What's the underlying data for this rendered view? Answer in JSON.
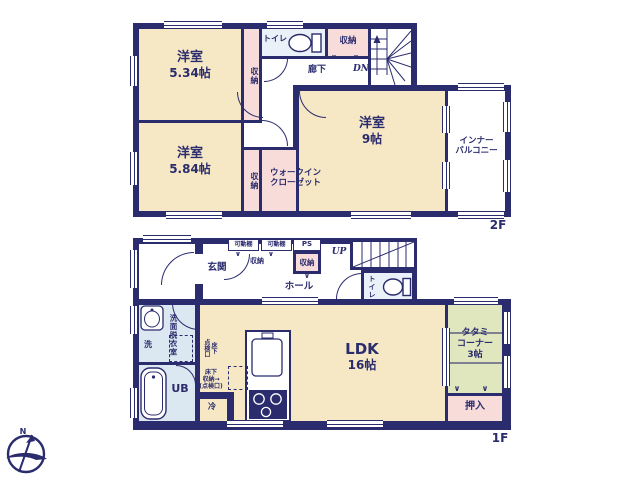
{
  "colors": {
    "wall": "#2b2c6e",
    "room": "#f6e8c4",
    "storage": "#f8dcd9",
    "tatami": "#e0e6bd",
    "wet": "#dce8f1",
    "toilet": "#eaf1f8"
  },
  "floor2": {
    "label": "2F",
    "bedroom_small": {
      "name": "洋室",
      "size": "5.34帖"
    },
    "bedroom_mid": {
      "name": "洋室",
      "size": "5.84帖"
    },
    "bedroom_large": {
      "name": "洋室",
      "size": "9帖"
    },
    "closet_left_top": "収納",
    "closet_left_bottom": "収納",
    "closet_hall": "収納",
    "toilet": "トイレ",
    "hallway": "廊下",
    "stairs_down": "DN",
    "wic": {
      "line1": "ウォークイン",
      "line2": "クローゼット"
    },
    "balcony": {
      "line1": "インナー",
      "line2": "バルコニー"
    }
  },
  "floor1": {
    "label": "1F",
    "entrance": "玄関",
    "hall": "ホール",
    "shelf_left": "可動棚",
    "shelf_right": "可動棚",
    "entrance_closet": "収納",
    "ps": "PS",
    "hall_closet": "収納",
    "stairs_up": "UP",
    "toilet": "トイレ",
    "washroom": "洗面脱衣室",
    "washer": "洗",
    "bath": "UB",
    "fridge": "冷",
    "ldk": {
      "name": "LDK",
      "size": "16帖"
    },
    "tatami": {
      "line1": "タタミ",
      "line2": "コーナー",
      "line3": "3帖"
    },
    "oshiire": "押入",
    "floor_hatch": {
      "col1": "床下",
      "col2": "点検口"
    },
    "underfloor_storage": {
      "line1": "床下",
      "line2": "収納→",
      "line3": "(点検口)"
    }
  },
  "compass": {
    "north": "N"
  },
  "marks": {
    "chevron": "∨"
  }
}
